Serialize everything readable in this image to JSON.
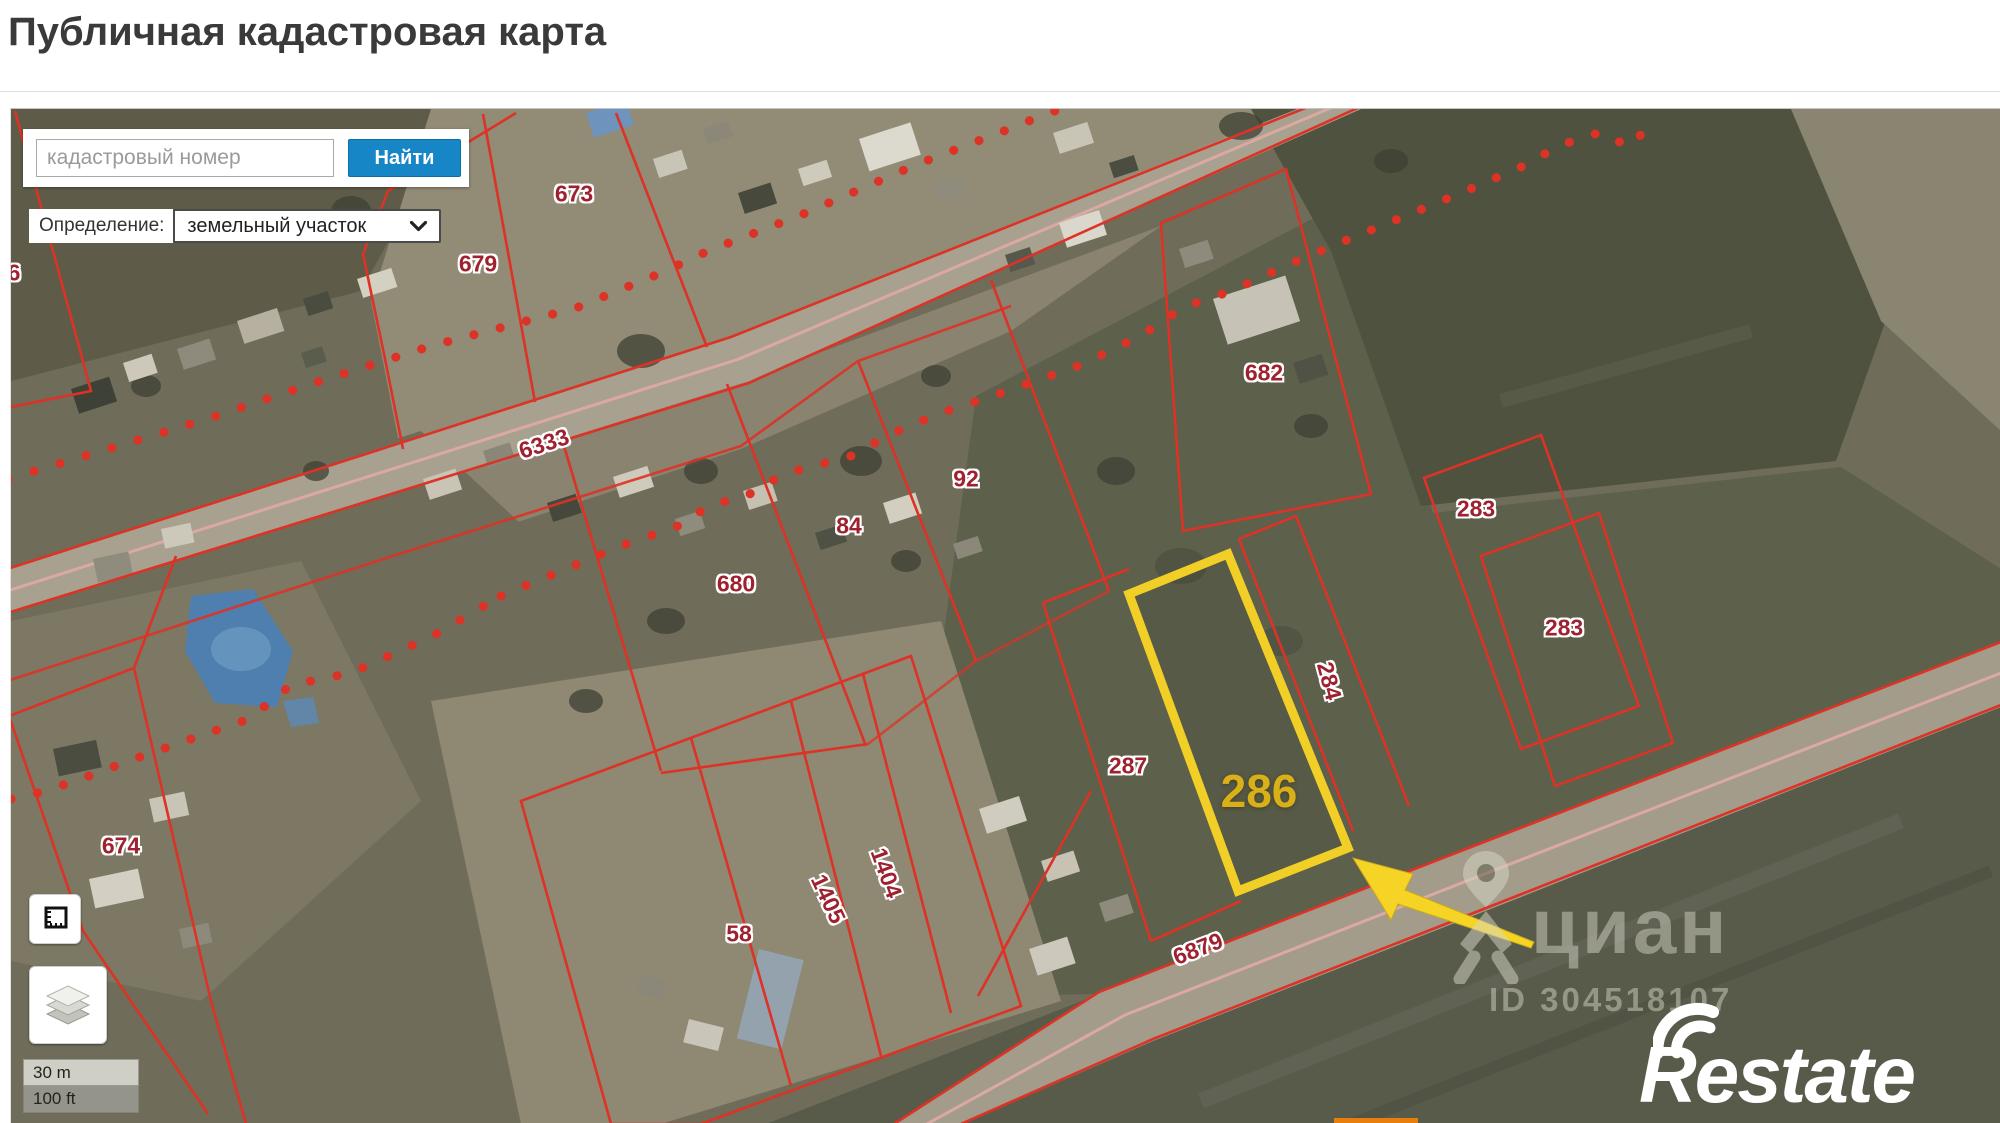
{
  "page": {
    "title": "Публичная кадастровая карта"
  },
  "search": {
    "placeholder": "кадастровый номер",
    "button_label": "Найти"
  },
  "filter": {
    "label": "Определение:",
    "selected_option": "земельный участок",
    "chevron_icon": "chevron-down"
  },
  "map": {
    "type": "cadastral-satellite-view",
    "colors": {
      "parcel_line": "#dd3226",
      "parcel_label": "#9e2130",
      "highlight": "#f2cf27",
      "highlight_label": "#d9b018",
      "road_center": "#dba9a2",
      "search_button_blue": "#1786c7"
    },
    "parcel_labels": [
      {
        "text": "673",
        "x": 573,
        "y": 193,
        "rot": 0
      },
      {
        "text": "679",
        "x": 477,
        "y": 263,
        "rot": 0
      },
      {
        "text": "6",
        "x": 13,
        "y": 272,
        "rot": 0
      },
      {
        "text": "6333",
        "x": 543,
        "y": 443,
        "rot": -18,
        "road": true
      },
      {
        "text": "84",
        "x": 848,
        "y": 525,
        "rot": 0
      },
      {
        "text": "92",
        "x": 965,
        "y": 478,
        "rot": 0
      },
      {
        "text": "680",
        "x": 735,
        "y": 583,
        "rot": 0
      },
      {
        "text": "682",
        "x": 1263,
        "y": 372,
        "rot": 0
      },
      {
        "text": "283",
        "x": 1475,
        "y": 508,
        "rot": 0
      },
      {
        "text": "283",
        "x": 1563,
        "y": 627,
        "rot": 0
      },
      {
        "text": "284",
        "x": 1328,
        "y": 680,
        "rot": 75
      },
      {
        "text": "287",
        "x": 1127,
        "y": 765,
        "rot": 0
      },
      {
        "text": "674",
        "x": 120,
        "y": 845,
        "rot": 0
      },
      {
        "text": "58",
        "x": 738,
        "y": 933,
        "rot": 0
      },
      {
        "text": "1405",
        "x": 827,
        "y": 898,
        "rot": 65
      },
      {
        "text": "1404",
        "x": 885,
        "y": 872,
        "rot": 70
      },
      {
        "text": "6879",
        "x": 1197,
        "y": 948,
        "rot": -21,
        "road": true
      }
    ],
    "highlight_parcel": {
      "label": "286"
    },
    "tools": [
      {
        "name": "measure-area"
      },
      {
        "name": "layers"
      }
    ],
    "scale": {
      "metric": "30 m",
      "imperial": "100 ft"
    },
    "watermarks": {
      "brand": "циан",
      "listing_id": "ID 304518107",
      "agency_logo": "Restate"
    }
  }
}
